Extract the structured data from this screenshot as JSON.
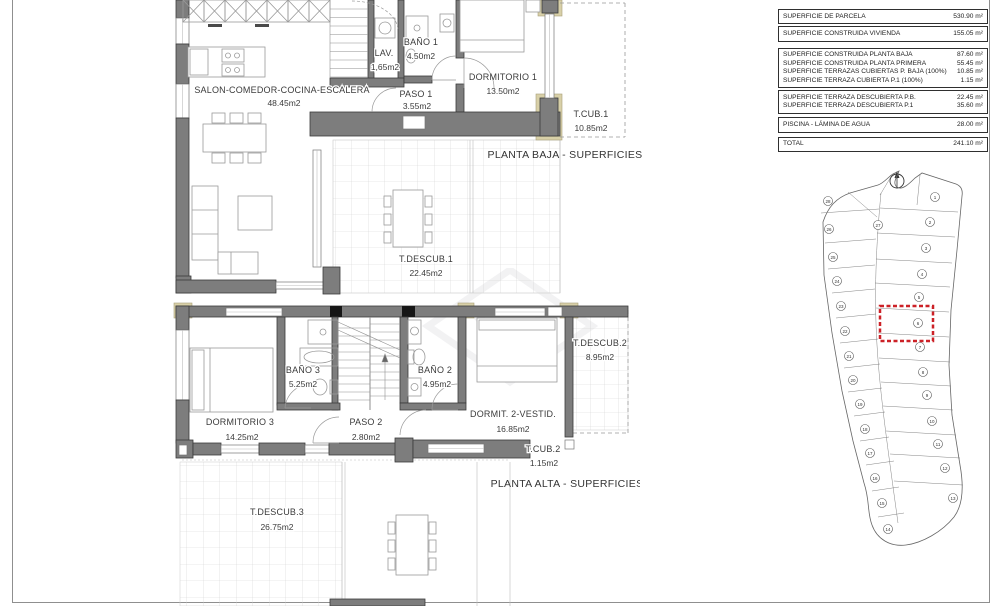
{
  "summary_table": {
    "groups": [
      {
        "rows": [
          {
            "label": "SUPERFICIE DE PARCELA",
            "value": "530.90 m²"
          }
        ]
      },
      {
        "rows": [
          {
            "label": "SUPERFICIE CONSTRUIDA VIVIENDA",
            "value": "155.05 m²"
          }
        ]
      },
      {
        "rows": [
          {
            "label": "SUPERFICIE CONSTRUIDA PLANTA BAJA",
            "value": "87.60 m²"
          },
          {
            "label": "SUPERFICIE CONSTRUIDA PLANTA PRIMERA",
            "value": "55.45 m²"
          },
          {
            "label": "SUPERFICIE TERRAZAS CUBIERTAS P. BAJA (100%)",
            "value": "10.85 m²"
          },
          {
            "label": "SUPERFICIE TERRAZA CUBIERTA P.1 (100%)",
            "value": "1.15 m²"
          }
        ]
      },
      {
        "rows": [
          {
            "label": "SUPERFICIE TERRAZA DESCUBIERTA P.B.",
            "value": "22.45 m²"
          },
          {
            "label": "SUPERFICIE TERRAZA DESCUBIERTA P.1",
            "value": "35.60 m²"
          }
        ]
      },
      {
        "rows": [
          {
            "label": "PISCINA - LÁMINA DE AGUA",
            "value": "28.00 m²"
          }
        ]
      },
      {
        "rows": [
          {
            "label": "TOTAL",
            "value": "241.10 m²"
          }
        ]
      }
    ]
  },
  "plans": {
    "baja": {
      "title": "PLANTA BAJA - SUPERFICIES",
      "rooms": [
        {
          "name": "SALON-COMEDOR-COCINA-ESCALERA",
          "area": "48.45m2"
        },
        {
          "name": "LAV.",
          "area": "1,65m2"
        },
        {
          "name": "BAÑO 1",
          "area": "4.50m2"
        },
        {
          "name": "PASO 1",
          "area": "3.55m2"
        },
        {
          "name": "DORMITORIO 1",
          "area": "13.50m2"
        },
        {
          "name": "T.CUB.1",
          "area": "10.85m2"
        },
        {
          "name": "T.DESCUB.1",
          "area": "22.45m2"
        }
      ]
    },
    "alta": {
      "title": "PLANTA ALTA - SUPERFICIES",
      "rooms": [
        {
          "name": "DORMITORIO 3",
          "area": "14.25m2"
        },
        {
          "name": "BAÑO 3",
          "area": "5.25m2"
        },
        {
          "name": "PASO 2",
          "area": "2.80m2"
        },
        {
          "name": "BAÑO 2",
          "area": "4.95m2"
        },
        {
          "name": "DORMIT. 2-VESTID.",
          "area": "16.85m2"
        },
        {
          "name": "T.DESCUB.2",
          "area": "8.95m2"
        },
        {
          "name": "T.CUB.2",
          "area": "1.15m2"
        },
        {
          "name": "T.DESCUB.3",
          "area": "26.75m2"
        }
      ]
    }
  },
  "site_plan": {
    "highlighted_plot": "6",
    "right_plots": [
      "1",
      "2",
      "3",
      "4",
      "5",
      "6",
      "7",
      "8",
      "9",
      "10",
      "11",
      "12",
      "13"
    ],
    "left_plots": [
      "28",
      "27",
      "26",
      "25",
      "24",
      "23",
      "22",
      "21",
      "20",
      "19",
      "18",
      "17",
      "16",
      "15",
      "14"
    ]
  },
  "colors": {
    "highlight_red": "#cc2127",
    "wall_gray": "#7d7d7d",
    "accent_tan": "#d8d0a8"
  }
}
